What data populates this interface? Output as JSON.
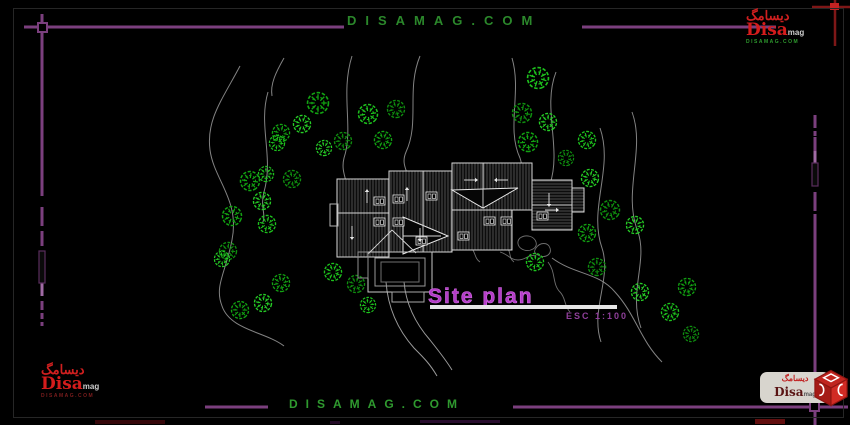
{
  "watermark": {
    "text": "DISAMAG.COM"
  },
  "title": {
    "text": "Site plan",
    "scale": "ESC 1:100"
  },
  "logo": {
    "persian": "دیسامگ",
    "brand": "Disa",
    "brand_suffix": "mag",
    "url": "DISAMAG.COM"
  },
  "colors": {
    "background": "#000000",
    "frame_purple": "#7b3f7e",
    "frame_purple_light": "#a06aa4",
    "frame_red": "#7e1717",
    "frame_red_bright": "#c32222",
    "watermark_green": "#2b882b",
    "tree_green": "#1dc21d",
    "contour_gray": "#9a9a9a",
    "title_magenta": "#b33cc7",
    "building_line": "#d8d8d8",
    "underline_white": "#e6e6e6"
  },
  "frame": {
    "purple_segs": [
      [
        24,
        27,
        344,
        27
      ],
      [
        582,
        27,
        776,
        27
      ],
      [
        42,
        14,
        42,
        196
      ],
      [
        42,
        207,
        42,
        226
      ],
      [
        42,
        231,
        42,
        246
      ],
      [
        42,
        301,
        42,
        310
      ],
      [
        42,
        313,
        42,
        319
      ],
      [
        42,
        322,
        42,
        326
      ],
      [
        815,
        115,
        815,
        128
      ],
      [
        815,
        131,
        815,
        136
      ],
      [
        815,
        137,
        815,
        151
      ],
      [
        815,
        192,
        815,
        211
      ],
      [
        815,
        214,
        815,
        231
      ],
      [
        815,
        231,
        815,
        402
      ],
      [
        815,
        411,
        815,
        425
      ],
      [
        205,
        407,
        268,
        407
      ],
      [
        513,
        407,
        811,
        407
      ],
      [
        820,
        407,
        848,
        407
      ]
    ],
    "purple_light_segs": [
      [
        42,
        283,
        42,
        296
      ],
      [
        815,
        151,
        815,
        163
      ]
    ],
    "outline_rects": [
      [
        39,
        251,
        6,
        32
      ],
      [
        812,
        163,
        6,
        23
      ]
    ],
    "nodes": [
      [
        38,
        23,
        9,
        9
      ],
      [
        810,
        402,
        9,
        9
      ]
    ],
    "red_segs": [
      [
        835,
        0,
        835,
        46
      ],
      [
        812,
        7,
        850,
        7
      ]
    ],
    "red_node": [
      830,
      3,
      9,
      7
    ]
  },
  "drawing": {
    "contours": [
      "M240,66 C222,100 206,120 210,150 C214,180 240,200 232,240 C226,272 214,286 222,306 C230,330 266,332 284,346",
      "M268,92 C258,126 274,156 264,192 C260,206 266,214 263,222",
      "M352,56 C340,94 354,128 344,158 C340,174 350,182 347,198",
      "M420,56 C406,90 420,122 406,152 C400,166 410,172 407,180",
      "M512,58 C522,92 506,128 520,158 C526,176 516,182 519,190",
      "M556,72 C542,108 562,148 550,184 C546,196 552,200 550,208",
      "M600,128 C614,168 588,208 602,248 C612,278 590,310 601,342",
      "M632,112 C646,150 622,192 638,232 C648,262 628,292 641,328",
      "M552,258 C575,275 598,272 615,292 C636,315 640,340 662,362",
      "M284,58 C276,72 270,84 272,96"
    ],
    "walkways": [
      "M386,282 C388,308 398,330 414,348 C424,358 430,364 437,376",
      "M404,282 C406,304 416,324 430,340 C438,350 446,360 452,370"
    ],
    "stream": [
      "M478,228 C488,238 498,236 506,246 C512,252 508,258 514,262",
      "M520,238 c6,-4 14,-2 16,4 c2,6 -6,10 -12,8 c-6,-2 -8,-8 -4,-12 z",
      "M500,252 c8,2 10,8 18,8 c8,0 10,-6 18,-4",
      "M536,248 c4,-6 12,-6 14,0 c2,6 -4,10 -10,8 c-5,-2 -7,-4 -4,-8 z",
      "M548,262 C556,272 552,284 560,292 C566,298 564,306 570,312",
      "M470,246 c6,6 4,12 10,16"
    ],
    "trees": [
      [
        318,
        103,
        11
      ],
      [
        368,
        114,
        10
      ],
      [
        396,
        109,
        9
      ],
      [
        302,
        124,
        9
      ],
      [
        281,
        133,
        9
      ],
      [
        277,
        143,
        8
      ],
      [
        343,
        141,
        9
      ],
      [
        324,
        148,
        8
      ],
      [
        383,
        140,
        9
      ],
      [
        538,
        78,
        11
      ],
      [
        522,
        113,
        10
      ],
      [
        548,
        122,
        9
      ],
      [
        528,
        142,
        10
      ],
      [
        587,
        140,
        9
      ],
      [
        566,
        158,
        8
      ],
      [
        590,
        178,
        9
      ],
      [
        250,
        181,
        10
      ],
      [
        266,
        174,
        8
      ],
      [
        292,
        179,
        9
      ],
      [
        262,
        201,
        9
      ],
      [
        232,
        216,
        10
      ],
      [
        267,
        224,
        9
      ],
      [
        228,
        251,
        9
      ],
      [
        222,
        259,
        8
      ],
      [
        281,
        283,
        9
      ],
      [
        333,
        272,
        9
      ],
      [
        356,
        284,
        9
      ],
      [
        263,
        303,
        9
      ],
      [
        240,
        310,
        9
      ],
      [
        368,
        305,
        8
      ],
      [
        610,
        210,
        10
      ],
      [
        635,
        225,
        9
      ],
      [
        587,
        233,
        9
      ],
      [
        535,
        262,
        9
      ],
      [
        597,
        267,
        9
      ],
      [
        640,
        292,
        9
      ],
      [
        687,
        287,
        9
      ],
      [
        670,
        312,
        9
      ],
      [
        691,
        334,
        8
      ]
    ],
    "tree_colors": [
      "#12a312",
      "#1dc21d",
      "#0f8f0f",
      "#26cf26"
    ],
    "building": {
      "planes": [
        {
          "points": "337,179 389,179 389,257 337,257",
          "hatch": "v"
        },
        {
          "points": "389,171 452,171 452,252 389,252",
          "hatch": "v"
        },
        {
          "points": "452,210 512,210 512,250 452,250",
          "hatch": "v"
        },
        {
          "points": "452,163 532,163 532,210 452,210",
          "hatch": "v"
        },
        {
          "points": "532,180 572,180 572,230 532,230",
          "hatch": "h"
        },
        {
          "points": "572,188 584,188 584,212 572,212",
          "hatch": "h"
        }
      ],
      "triangles": [
        {
          "points": "403,217 448,236 403,254"
        },
        {
          "points": "452,190 518,188 483,208"
        }
      ],
      "lines": [
        [
          337,
          213,
          389,
          213
        ],
        [
          423,
          171,
          423,
          252
        ],
        [
          532,
          205,
          572,
          205
        ],
        [
          368,
          254,
          392,
          230
        ],
        [
          416,
          253,
          392,
          230
        ],
        [
          403,
          236,
          441,
          236
        ],
        [
          483,
          163,
          483,
          208
        ]
      ],
      "deck_rects": [
        [
          368,
          252,
          64,
          40,
          "#c9c9c9"
        ],
        [
          375,
          258,
          50,
          28,
          "#989898"
        ],
        [
          381,
          262,
          38,
          20,
          "#6f6f6f"
        ],
        [
          392,
          292,
          32,
          10,
          "#a8a8a8"
        ],
        [
          358,
          252,
          10,
          26,
          "#909090"
        ],
        [
          330,
          204,
          8,
          22,
          "#b5b5b5"
        ]
      ],
      "windows": [
        [
          374,
          197
        ],
        [
          393,
          195
        ],
        [
          374,
          218
        ],
        [
          393,
          218
        ],
        [
          426,
          192
        ],
        [
          458,
          232
        ],
        [
          484,
          217
        ],
        [
          501,
          217
        ],
        [
          537,
          212
        ],
        [
          416,
          237
        ]
      ],
      "arrows": [
        [
          367,
          203,
          "up"
        ],
        [
          407,
          201,
          "up"
        ],
        [
          352,
          226,
          "down"
        ],
        [
          420,
          228,
          "down"
        ],
        [
          464,
          180,
          "right"
        ],
        [
          508,
          180,
          "left"
        ],
        [
          549,
          193,
          "down"
        ],
        [
          545,
          210,
          "right"
        ]
      ]
    }
  },
  "artifacts": [
    [
      95,
      420,
      70,
      4,
      "#43090c"
    ],
    [
      330,
      421,
      10,
      3,
      "#2c0e31"
    ],
    [
      420,
      420,
      80,
      3,
      "#33103a"
    ],
    [
      755,
      419,
      30,
      5,
      "#7a1212"
    ]
  ]
}
